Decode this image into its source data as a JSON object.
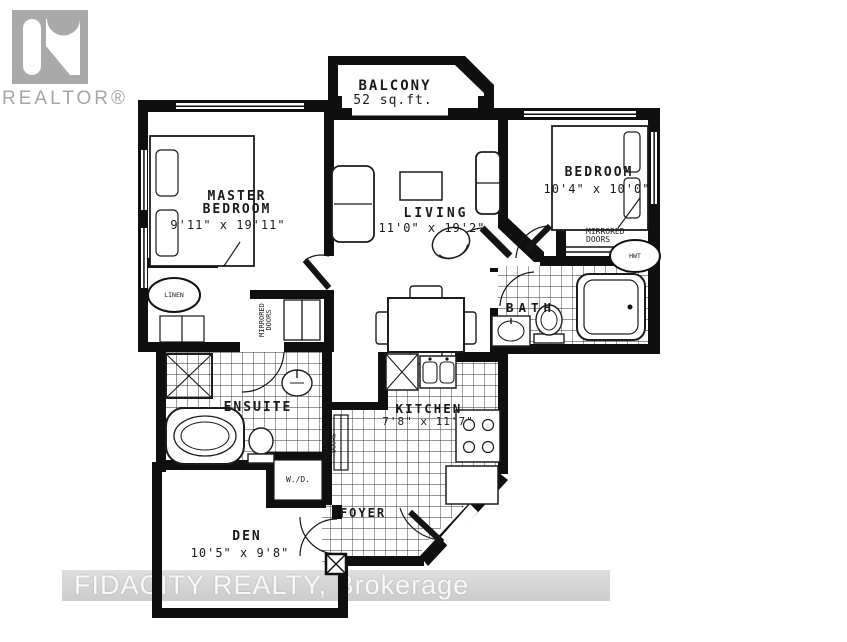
{
  "logo": {
    "brand": "REALTOR®"
  },
  "watermark": {
    "text": "FIDACITY REALTY, Brokerage"
  },
  "rooms": {
    "balcony": {
      "name": "BALCONY",
      "area": "52 sq.ft."
    },
    "master_bedroom": {
      "name": "MASTER BEDROOM",
      "dims": "9'11\" x 19'11\""
    },
    "living": {
      "name": "LIVING",
      "dims": "11'0\" x 19'2\""
    },
    "bedroom": {
      "name": "BEDROOM",
      "dims": "10'4\" x 10'0\""
    },
    "bath": {
      "name": "BATH"
    },
    "ensuite": {
      "name": "ENSUITE"
    },
    "kitchen": {
      "name": "KITCHEN",
      "dims": "7'8\" x 11'7\""
    },
    "foyer": {
      "name": "FOYER"
    },
    "den": {
      "name": "DEN",
      "dims": "10'5\" x 9'8\""
    }
  },
  "labels": {
    "mirrored_doors": "MIRRORED DOORS",
    "linen": "LINEN",
    "hwt": "HWT",
    "washer_dryer": "W./D."
  },
  "colors": {
    "wall": "#0f0f0f",
    "logo": "#a9a9a9",
    "watermark_band": "#d6d6d6",
    "watermark_text": "#f8f8f8"
  }
}
